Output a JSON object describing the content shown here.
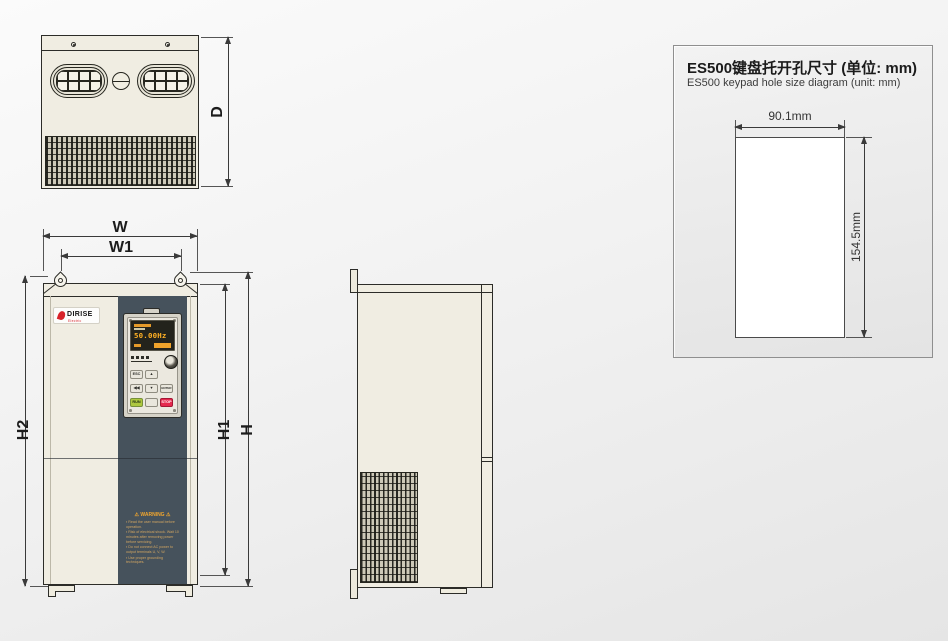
{
  "dims": {
    "d": "D",
    "w": "W",
    "w1": "W1",
    "h": "H",
    "h1": "H1",
    "h2": "H2"
  },
  "front": {
    "logo": {
      "text": "DIRISE",
      "subtext": "Electric"
    },
    "keypad": {
      "display": "50.00Hz",
      "esc": "ESC",
      "up": "▲",
      "shift": "◀◀",
      "down": "▼",
      "enter": "ENTER",
      "run": "RUN",
      "jog": "",
      "stop": "STOP"
    },
    "warning": {
      "title": "⚠ WARNING ⚠",
      "lines": [
        "▪ Read the user manual before operation.",
        "▪ Risk of electrical shock. Wait 10 minutes after removing power before servicing.",
        "▪ Do not connect AC power to output terminals U, V, W.",
        "▪ Use proper grounding techniques."
      ]
    }
  },
  "panel": {
    "title_zh": "ES500键盘托开孔尺寸 (单位: mm)",
    "title_en": "ES500 keypad hole size diagram (unit: mm)",
    "width_label": "90.1mm",
    "height_label": "154.5mm"
  },
  "colors": {
    "body_cream": "#f0ede2",
    "stripe_slate": "#46525c",
    "warning_orange": "#f2a62e",
    "display_amber": "#ffb024",
    "run_green": "#aec83f",
    "stop_red": "#e5294e",
    "logo_red": "#d8232a",
    "line": "#2c2c28"
  }
}
